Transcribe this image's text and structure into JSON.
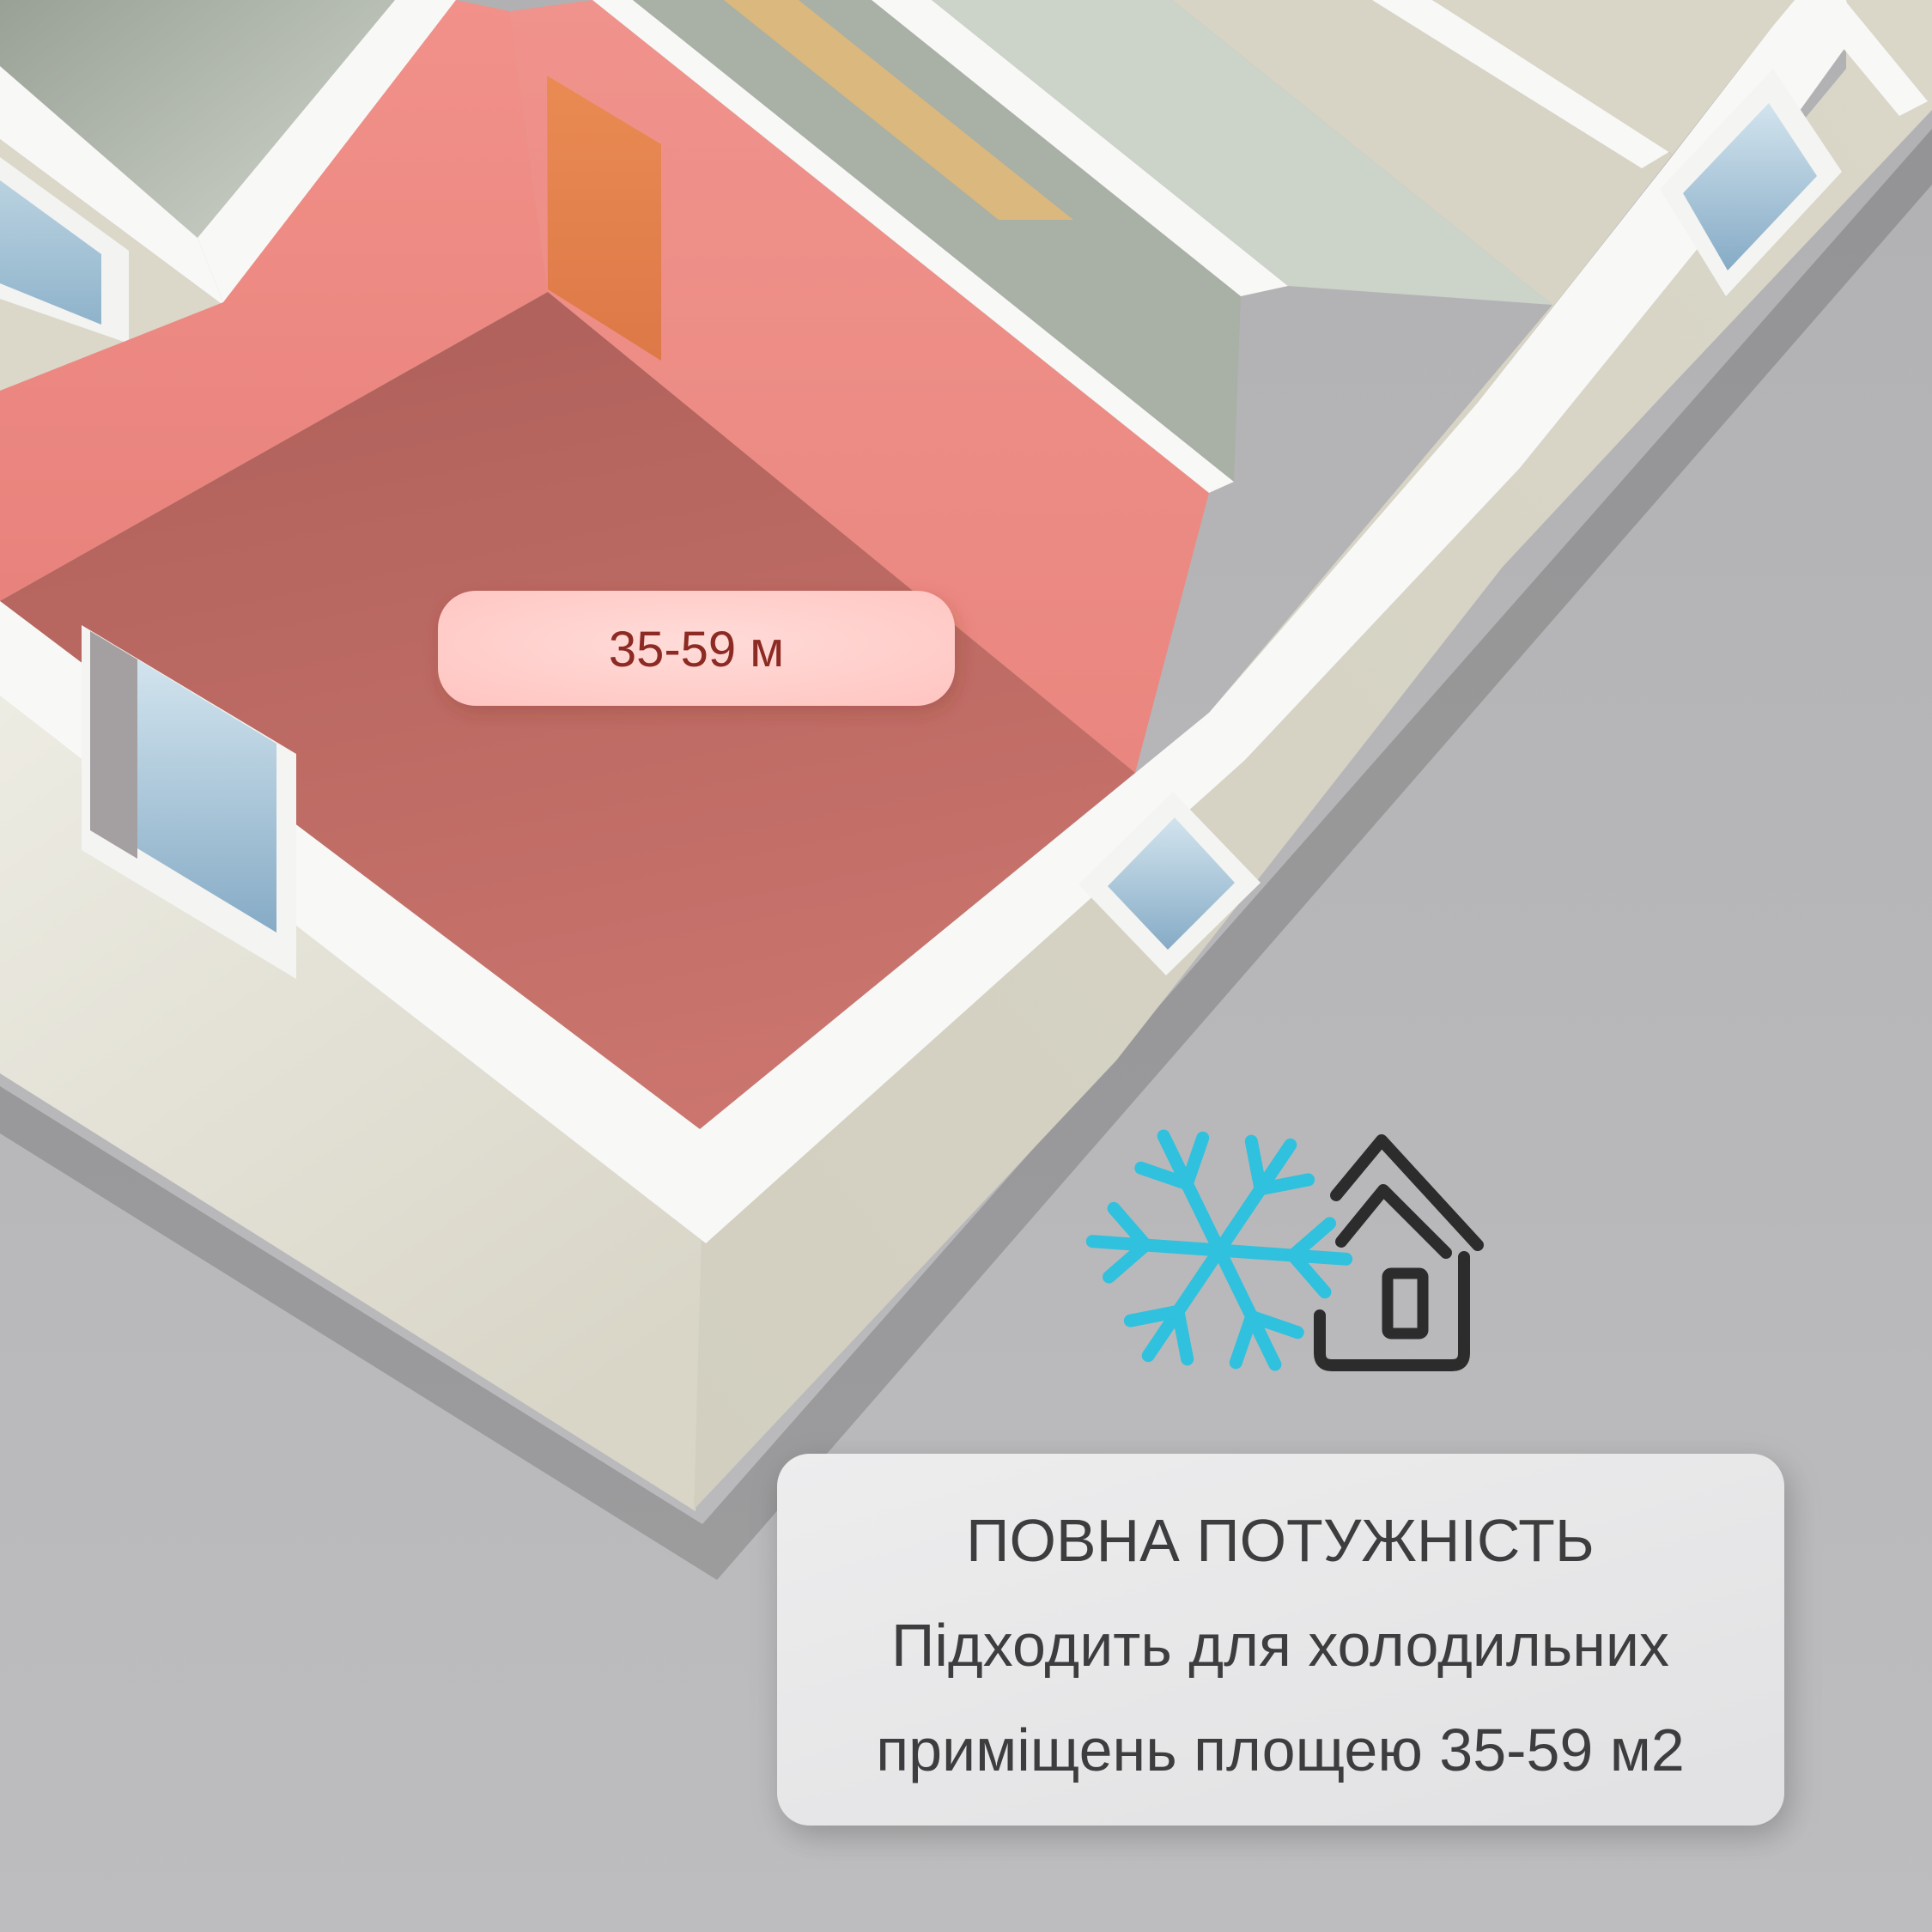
{
  "scene": {
    "room_area_label": "35-59 м",
    "highlight_wall_color": "#ee8e87",
    "highlight_floor_color": "#bd6c65",
    "door_color": "#e8884f",
    "exterior_wall_color": "#dcd9cb",
    "wall_top_color": "#f8f8f7",
    "window_glass_color": "#8fb3cb",
    "background_color": "#b5b5b7"
  },
  "icons": {
    "snowflake_icon_color": "#2fc1dd",
    "house_icon_color": "#2c2c2c"
  },
  "info_card": {
    "title": "ПОВНА ПОТУЖНІСТЬ",
    "line2": "Підходить для холодильних",
    "line3": "приміщень площею 35-59 м2",
    "text_color": "#3d3d3f",
    "background_color": "#e8e8e9"
  }
}
